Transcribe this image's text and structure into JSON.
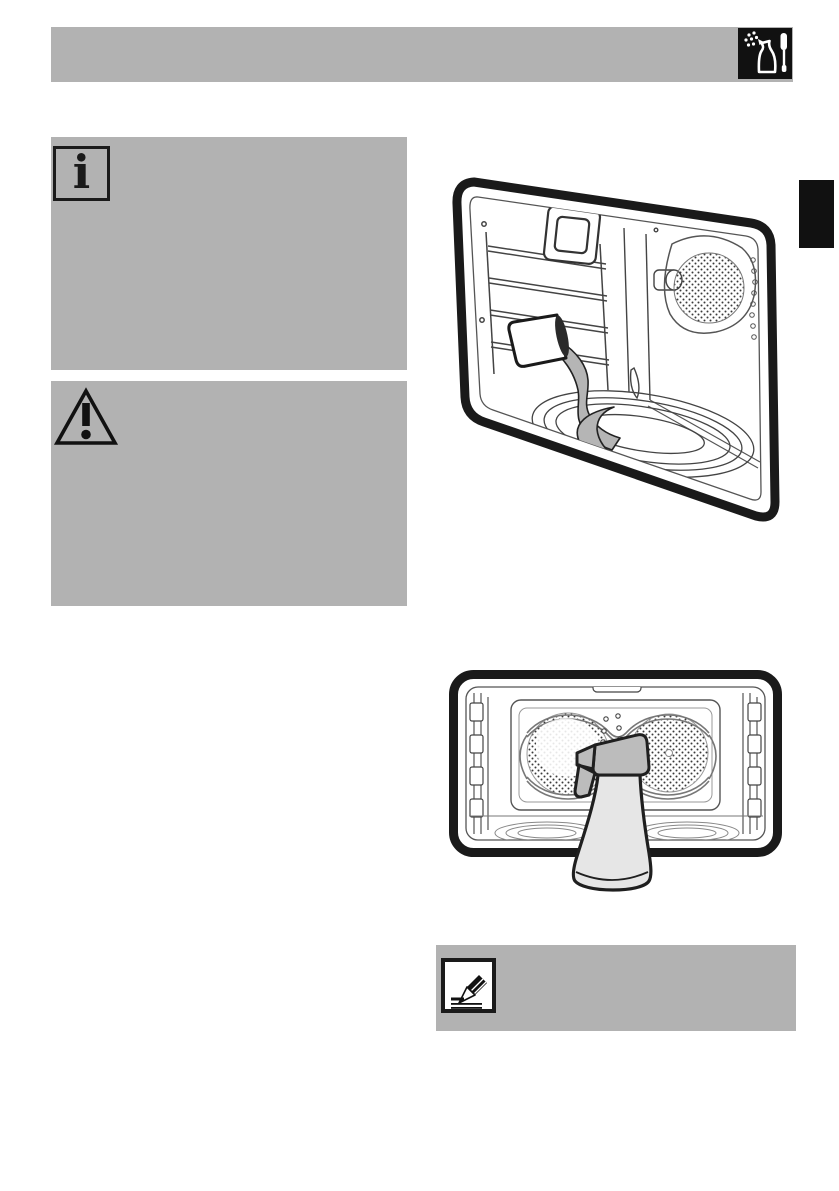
{
  "page": {
    "kind": "appliance-manual-page",
    "topic": "oven-cleaning-instructions"
  },
  "colors": {
    "box_gray": "#b2b2b2",
    "ink_black": "#1a1a1a",
    "line_art": "#444444",
    "water_gray": "#b5b5b5",
    "bottle_body_gray": "#e6e6e6",
    "bottle_head_gray": "#bcbcbc",
    "page_white": "#ffffff"
  },
  "header": {
    "icon": "cleaning-spray-and-brush-icon"
  },
  "side_tab": {
    "icon": "chapter-edge-marker"
  },
  "callouts": [
    {
      "id": "info",
      "icon": "info-icon",
      "glyph": "i"
    },
    {
      "id": "warning",
      "icon": "warning-triangle-icon",
      "glyph": "!"
    },
    {
      "id": "note",
      "icon": "pencil-note-icon"
    }
  ],
  "figures": [
    {
      "id": "figure-1",
      "name": "oven-interior-pouring-water-into-floor-recess"
    },
    {
      "id": "figure-2",
      "name": "oven-interior-spray-bottle-cleaning-back-wall"
    }
  ]
}
